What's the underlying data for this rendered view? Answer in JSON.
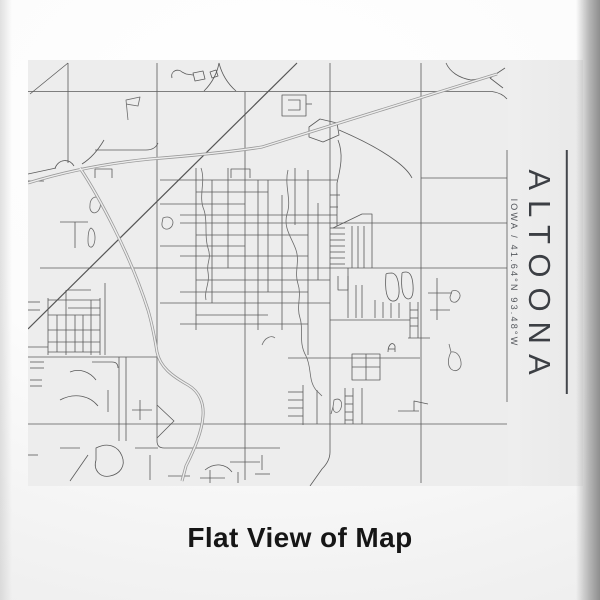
{
  "product": {
    "title": "ALTOONA",
    "subtitle": "IOWA / 41.64°N 93.48°W",
    "caption": "Flat View of Map"
  },
  "colors": {
    "accent": "#43464b",
    "map_background": "#ededed",
    "road": "#5a5a5a",
    "highway": "#9a9a9a",
    "caption_text": "#161616"
  },
  "map": {
    "viewBox": "28 60 480 426",
    "width": 480,
    "height": 426,
    "layers": [
      {
        "name": "roads-layer",
        "stroke": "#5a5a5a",
        "width": 0.8,
        "paths": [
          "M28,91.5 H492 Q502,93 507,99",
          "M68,63 V163",
          "M157,63 V441 Q157,448 164,448 H280",
          "M245,92 V480",
          "M330,63 V452 Q330,461 322,469 L310,486",
          "M421,63 V483",
          "M507,150 V402",
          "M28,424 H507",
          "M180,223 H507",
          "M40,268 H507",
          "M28,357 H157",
          "M30,94 L68,63",
          "M421,178 H507",
          "M28,181 H44",
          "M28,174 L56,168",
          "M55,168 C59,159 69,158 74,166",
          "M490,78 L505,68",
          "M490,78 L503,88",
          "M446,63 C450,72 459,78 471,80 L492,77",
          "M104,140 C97,152 90,159 82,164",
          "M219,63 C217,74 211,84 204,91",
          "M219,63 C222,75 228,84 236,91",
          "M95,150 H146 Q155,150 158,143",
          "M339,130 C360,139 380,149 396,161 C404,167 409,172 412,178",
          "M338,140 C344,155 340,170 337,183",
          "M196,168 V330",
          "M212,180 V303",
          "M228,168 V268",
          "M258,180 V330",
          "M268,180 V292",
          "M282,195 V330",
          "M295,168 V225",
          "M308,170 V355",
          "M318,203 V280",
          "M337,183 V226",
          "M160,180 H337",
          "M196,192 H268",
          "M160,204 H245",
          "M180,215 H337",
          "M196,235 H308",
          "M160,246 H245",
          "M180,256 H308",
          "M196,280 H330",
          "M180,292 H308",
          "M160,303 H330",
          "M196,315 H268",
          "M180,324 H308",
          "M330,195 H340",
          "M330,207 H338",
          "M333,228 L362,214 H372 L372,226",
          "M352,226 V268",
          "M358,226 V268",
          "M364,226 V268",
          "M372,226 V268",
          "M330,228 H345",
          "M330,234 H345",
          "M330,240 H345",
          "M330,246 H345",
          "M330,252 H345",
          "M330,258 H345",
          "M330,264 H345",
          "M348,268 V318",
          "M356,285 V318",
          "M362,285 V318",
          "M338,276 V290 H348 V276",
          "M386,274 Q384,299 392,301 Q400,302 399,288 Q398,274 392,273 Q387,273 386,274",
          "M402,273 Q400,297 408,299 Q414,299 413,285 Q412,272 406,272 Q403,272 402,273",
          "M375,300 V318",
          "M383,302 V318",
          "M391,303 V318",
          "M399,303 V318",
          "M330,320 H410",
          "M410,302 V338",
          "M418,302 V338",
          "M410,310 H418",
          "M410,318 H418",
          "M410,326 H418",
          "M408,338 H430",
          "M428,293 H452",
          "M437,278 V320",
          "M430,310 H450",
          "M288,358 H420",
          "M352,354 H380 V380 H352 Z",
          "M366,354 V380",
          "M352,367 H380",
          "M303,385 V425",
          "M288,392 H303",
          "M288,400 H303",
          "M288,408 H303",
          "M288,416 H303",
          "M317,390 V424",
          "M345,388 V424",
          "M353,388 V424",
          "M345,396 H353",
          "M345,404 H353",
          "M345,412 H353",
          "M345,420 H353",
          "M362,388 V424",
          "M388,352 C388,344 393,341 395,346 L395,352",
          "M388,349 H395",
          "M398,411 H419",
          "M414,411 V401 L428,404",
          "M48,298 V355",
          "M57,315 V352",
          "M66,290 V355",
          "M75,315 V352",
          "M83,315 V352",
          "M91,300 V355",
          "M100,298 V355",
          "M48,300 H100",
          "M68,290 H91",
          "M48,315 H100",
          "M68,308 H100",
          "M48,330 H100",
          "M48,342 H100",
          "M48,352 H100",
          "M105,283 V355",
          "M119,357 V441",
          "M126,357 V441",
          "M28,302 H40",
          "M28,310 H40",
          "M28,347 H48",
          "M30,362 H44",
          "M30,368 H44",
          "M30,380 H42",
          "M30,386 H42",
          "M92,362 H112 Q118,362 118,368",
          "M70,372 C80,368 90,372 96,380",
          "M60,400 C75,392 90,396 98,406",
          "M108,390 V412",
          "M140,400 V420",
          "M132,410 H152",
          "M157,405 L174,421 L157,438",
          "M88,455 L70,481",
          "M135,448 H158",
          "M150,455 V480",
          "M60,448 H80",
          "M28,455 H38",
          "M96,448 C108,442 118,446 122,456 C126,466 120,474 110,476 C100,478 93,470 96,460 Z",
          "M230,462 H260",
          "M205,470 C215,462 226,464 232,472",
          "M262,455 V470",
          "M168,476 H190",
          "M200,478 H225",
          "M255,474 H270",
          "M210,470 V483",
          "M238,472 V483",
          "M60,222 H88",
          "M75,222 V248",
          "M95,178 V169 H112 V178",
          "M231,178 V169 H250 V178",
          "M282,95 H306 V116 H282 Z",
          "M288,100 H300 V110 H288",
          "M306,104 H312",
          "M309,127 L320,119 L337,123 L339,135 L323,142 L309,137 Z",
          "M172,78 C170,71 178,68 182,72 L186,74",
          "M186,74 L193,75",
          "M193,73 L203,71 L205,79 L195,81 Z",
          "M210,72 L216,70 L218,76 L212,78 Z"
        ]
      },
      {
        "name": "water-layer",
        "stroke": "#6b6b6b",
        "width": 0.8,
        "paths": [
          "M128,120 L126,100 L140,97 L138,106 L126,104",
          "M96,197 C101,199 102,206 98,211 C94,215 89,212 90,205 C90,200 93,197 96,197 Z",
          "M91,228 C95,230 96,238 94,244 C92,249 88,248 88,241 C88,234 89,229 91,228 Z",
          "M163,218 C170,215 175,220 172,226 C169,231 161,230 162,223 Z",
          "M452,291 C458,289 462,294 459,299 C456,304 450,303 450,297 Z",
          "M451,352 C448,358 447,365 451,369 C456,373 462,369 461,362 C460,355 456,351 451,352 Z",
          "M451,352 L449,344",
          "M262,345 C265,337 272,335 275,338",
          "M334,400 C340,397 343,402 341,408 C339,414 333,414 333,407 Z",
          "M333,407 L331,414",
          "M201,168 C206,182 198,196 204,210 C208,222 204,236 208,248 C212,260 206,262 208,272 C210,284 204,290 206,300",
          "M288,170 C284,186 292,200 287,214 C283,228 292,238 296,250 C300,262 294,272 298,284 C302,296 296,306 300,318 C304,330 298,342 306,356 C312,368 308,380 316,390 L322,396"
        ]
      },
      {
        "name": "rail-diagonal-layer",
        "stroke": "#555555",
        "width": 1.2,
        "paths": [
          "M297,63 L28,329"
        ]
      },
      {
        "name": "highways-layer",
        "stroke": "#9a9a9a",
        "width": 3,
        "overlay": {
          "stroke": "#ededed",
          "width": 1.4
        },
        "paths": [
          "M28,183 C70,170 110,163 150,159 C200,155 230,152 262,147 L497,74",
          "M80,168 C88,180 100,200 114,228 C128,256 140,285 148,310 C153,327 155,340 157,352 C160,367 172,376 188,385 C200,392 204,404 203,416 C202,432 194,450 186,466 L182,481"
        ]
      }
    ]
  }
}
